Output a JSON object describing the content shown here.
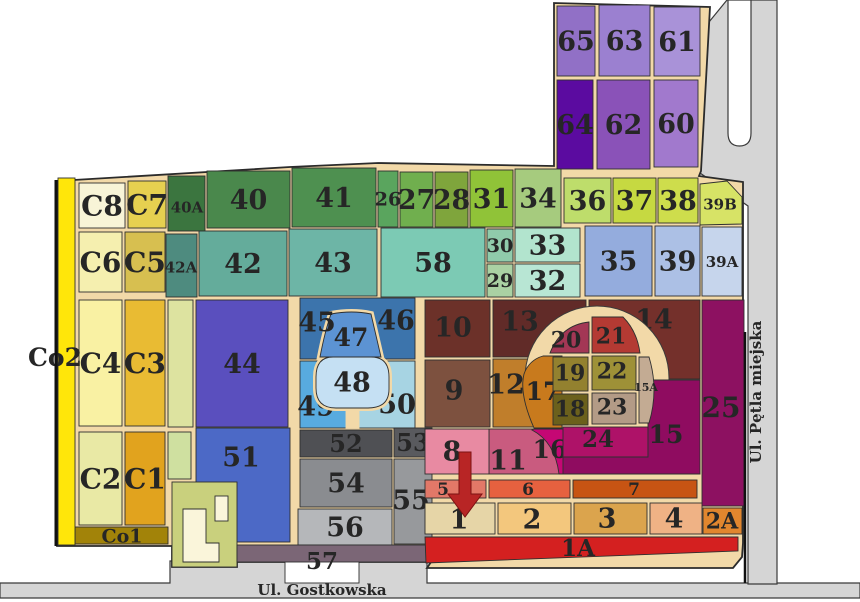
{
  "map": {
    "colors": {
      "road_fill": "#d5d5d5",
      "road_stroke": "#3a3a3a",
      "path_fill": "#f2d9a8",
      "outline": "#2b2b2b",
      "plot_stroke": "#2f2f2f",
      "label_color": "#262626",
      "arrow_color": "#b82525"
    },
    "base": "57,181 290,167 378,163 554,166 554,3 710,7 701,171 699,176 743,182 743,543 742,557 733,568 427,568 431,562 237,562 237,567 172,567 172,546 57,546",
    "roads": [
      {
        "name": "road-gostkowska-surface",
        "pg": "0,583 170,583 170,561 427,561 427,583 860,583 860,598 0,598"
      },
      {
        "name": "road-petla-miejska-surface",
        "pg": "700,33 727,0 777,0 777,584 748,584 748,206 700,173"
      },
      {
        "name": "turning-loop-island",
        "p": "M 728,0 L 728,133 Q 728,146 739.5,146 Q 751,146 751,133 L 751,0 Z",
        "c": "#ffffff"
      }
    ],
    "plots": [
      {
        "n": "65",
        "c": "#9170c6",
        "r": [
          557,
          6,
          38,
          70
        ]
      },
      {
        "n": "63",
        "c": "#9b80d0",
        "r": [
          599,
          5,
          51,
          71
        ]
      },
      {
        "n": "61",
        "c": "#a992d8",
        "r": [
          654,
          7,
          46,
          69
        ]
      },
      {
        "n": "64",
        "c": "#5b0ba0",
        "r": [
          557,
          80,
          36,
          89
        ]
      },
      {
        "n": "62",
        "c": "#8a52b8",
        "r": [
          597,
          80,
          53,
          89
        ]
      },
      {
        "n": "60",
        "c": "#a179cd",
        "r": [
          654,
          80,
          44,
          87
        ]
      },
      {
        "n": "C8",
        "c": "#f8f4d7",
        "r": [
          79,
          183,
          46,
          45
        ],
        "fs": 28
      },
      {
        "n": "C7",
        "c": "#e6d050",
        "r": [
          128,
          181,
          38,
          47
        ],
        "fs": 28
      },
      {
        "n": "40A",
        "c": "#3b753f",
        "r": [
          168,
          176,
          37,
          55
        ],
        "fs": 15,
        "lx": 187,
        "ly": 207
      },
      {
        "n": "40",
        "c": "#4a884c",
        "r": [
          207,
          171,
          83,
          57
        ]
      },
      {
        "n": "41",
        "c": "#4e9050",
        "r": [
          292,
          168,
          84,
          59
        ]
      },
      {
        "n": "26",
        "c": "#5aa55e",
        "r": [
          378,
          171,
          20,
          56
        ],
        "fs": 19
      },
      {
        "n": "27",
        "c": "#70af4e",
        "r": [
          400,
          172,
          33,
          55
        ]
      },
      {
        "n": "28",
        "c": "#7fa53c",
        "r": [
          435,
          172,
          33,
          55
        ]
      },
      {
        "n": "31",
        "c": "#90c338",
        "r": [
          470,
          170,
          43,
          57
        ]
      },
      {
        "n": "34",
        "c": "#a6cb7e",
        "r": [
          515,
          169,
          46,
          58
        ]
      },
      {
        "n": "36",
        "c": "#bedd6b",
        "r": [
          564,
          178,
          47,
          45
        ]
      },
      {
        "n": "37",
        "c": "#c6d941",
        "r": [
          613,
          178,
          43,
          45
        ]
      },
      {
        "n": "38",
        "c": "#cedd4c",
        "r": [
          658,
          178,
          40,
          45
        ]
      },
      {
        "n": "39B",
        "c": "#d7e366",
        "pg": "700,184 727,181 742,197 742,224 700,225",
        "fs": 15,
        "lx": 720,
        "ly": 204
      },
      {
        "n": "C6",
        "c": "#f5efaf",
        "r": [
          79,
          232,
          43,
          60
        ],
        "fs": 28
      },
      {
        "n": "C5",
        "c": "#d7bf50",
        "r": [
          125,
          232,
          40,
          60
        ],
        "fs": 28
      },
      {
        "n": "42A",
        "c": "#4e8b7f",
        "r": [
          166,
          234,
          31,
          63
        ],
        "fs": 15,
        "lx": 181,
        "ly": 267
      },
      {
        "n": "42",
        "c": "#64ac9b",
        "r": [
          199,
          231,
          88,
          65
        ]
      },
      {
        "n": "43",
        "c": "#6db5a6",
        "r": [
          289,
          229,
          88,
          67
        ]
      },
      {
        "n": "58",
        "c": "#7ccab4",
        "r": [
          381,
          228,
          104,
          69
        ]
      },
      {
        "n": "30",
        "c": "#90cbab",
        "r": [
          487,
          229,
          26,
          33
        ],
        "fs": 19
      },
      {
        "n": "33",
        "c": "#b2e4ce",
        "r": [
          515,
          228,
          65,
          34
        ]
      },
      {
        "n": "29",
        "c": "#aad1a3",
        "r": [
          487,
          264,
          26,
          33
        ],
        "fs": 19
      },
      {
        "n": "32",
        "c": "#b8e6d4",
        "r": [
          515,
          264,
          65,
          33
        ]
      },
      {
        "n": "35",
        "c": "#94acdd",
        "r": [
          585,
          226,
          67,
          70
        ]
      },
      {
        "n": "39",
        "c": "#acc0e5",
        "r": [
          655,
          226,
          45,
          70
        ]
      },
      {
        "n": "39A",
        "c": "#c6d5ec",
        "r": [
          702,
          227,
          40,
          69
        ],
        "fs": 15
      },
      {
        "name": "green-strip-upper",
        "c": "#dde3a0",
        "r": [
          168,
          300,
          25,
          127
        ]
      },
      {
        "n": "C4",
        "c": "#f9f1a3",
        "r": [
          79,
          300,
          43,
          126
        ],
        "fs": 28
      },
      {
        "n": "C3",
        "c": "#e9bb33",
        "r": [
          125,
          300,
          40,
          126
        ],
        "fs": 28
      },
      {
        "n": "44",
        "c": "#5a4fbe",
        "r": [
          196,
          300,
          92,
          127
        ]
      },
      {
        "name": "block-45-46",
        "c": "#3c74ac",
        "r": [
          300,
          298,
          115,
          61
        ]
      },
      {
        "n": "49",
        "c": "#58abdf",
        "r": [
          300,
          361,
          57,
          67
        ],
        "lx": 316,
        "ly": 406
      },
      {
        "n": "50",
        "c": "#a7d4e3",
        "r": [
          357,
          361,
          58,
          67
        ],
        "lx": 397,
        "ly": 404
      },
      {
        "name": "goblet-stem",
        "c": "#f2d9a8",
        "sc": "#f2d9a8",
        "r": [
          346,
          406,
          13,
          22
        ]
      },
      {
        "name": "goblet-outline-upper",
        "halo": "M 331,314 Q 352,310 371,314 L 381,357 L 320,357 Q 325,331 331,314 Z"
      },
      {
        "name": "goblet-outline-lower",
        "halo": "M 333,357 L 371,357 Q 389,357 389,377 L 389,389 Q 389,408 368,408 L 336,408 Q 316,408 316,388 L 316,377 Q 316,357 333,357 Z"
      },
      {
        "n": "47",
        "c": "#5c93d3",
        "p": "M 331,314 Q 352,310 371,314 L 381,357 L 320,357 Q 325,331 331,314 Z",
        "lx": 351,
        "ly": 337,
        "fs": 25
      },
      {
        "n": "48",
        "c": "#c5e0f3",
        "p": "M 333,357 L 371,357 Q 389,357 389,377 L 389,389 Q 389,408 368,408 L 336,408 Q 316,408 316,388 L 316,377 Q 316,357 333,357 Z",
        "lx": 352,
        "ly": 382
      },
      {
        "n": "45",
        "lx": 317,
        "ly": 322
      },
      {
        "n": "46",
        "lx": 396,
        "ly": 320
      },
      {
        "n": "10",
        "c": "#6c3129",
        "r": [
          425,
          300,
          65,
          57
        ],
        "lx": 453,
        "ly": 327
      },
      {
        "n": "13",
        "c": "#612b28",
        "r": [
          493,
          300,
          93,
          57
        ],
        "lx": 520,
        "ly": 321
      },
      {
        "n": "14",
        "c": "#74302b",
        "r": [
          589,
          300,
          111,
          79
        ],
        "lx": 654,
        "ly": 319
      },
      {
        "n": "9",
        "c": "#7d513f",
        "r": [
          425,
          360,
          65,
          67
        ],
        "lx": 454,
        "ly": 390
      },
      {
        "n": "12",
        "c": "#c07e2b",
        "r": [
          493,
          359,
          50,
          68
        ],
        "lx": 506,
        "ly": 384
      },
      {
        "n": "25",
        "c": "#8d1161",
        "r": [
          702,
          300,
          42,
          206
        ],
        "lx": 721,
        "ly": 407,
        "fs": 28
      },
      {
        "name": "ring-road-circle",
        "circle": [
          597,
          378,
          72
        ]
      },
      {
        "n": "11",
        "c": "#c95b7f",
        "r": [
          489,
          429,
          71,
          45
        ],
        "lx": 508,
        "ly": 460
      },
      {
        "n": "16",
        "c": "#c50774",
        "p": "M 534,429 L 589,429 L 589,474 L 559,474 Q 555,442 532,430 Z",
        "lx": 550,
        "ly": 449,
        "fs": 25
      },
      {
        "n": "24",
        "c": "#ae1268",
        "r": [
          563,
          427,
          85,
          30
        ],
        "lx": 598,
        "ly": 439,
        "fs": 23
      },
      {
        "n": "15",
        "c": "#8f0c60",
        "p": "M 648,380 L 700,380 L 700,474 L 563,474 L 563,457 L 648,457 Z",
        "lx": 666,
        "ly": 434,
        "fs": 25
      },
      {
        "n": "17",
        "c": "#c87a1d",
        "p": "M 543,356 L 562,356 L 562,428 L 534,428 Q 519,394 524,374 Q 529,360 543,356 Z",
        "lx": 543,
        "ly": 391,
        "fs": 25
      },
      {
        "n": "20",
        "c": "#a33755",
        "p": "M 550,353 L 589,353 L 589,322 Q 561,325 550,353 Z",
        "lx": 566,
        "ly": 340,
        "fs": 22
      },
      {
        "n": "21",
        "c": "#b43a33",
        "p": "M 592,353 L 592,317 L 623,317 Q 637,331 640,353 Z",
        "lx": 611,
        "ly": 336,
        "fs": 22
      },
      {
        "n": "19",
        "c": "#93812f",
        "r": [
          553,
          357,
          35,
          34
        ],
        "lx": 570,
        "ly": 373,
        "fs": 22
      },
      {
        "n": "22",
        "c": "#9e9137",
        "r": [
          592,
          356,
          44,
          34
        ],
        "lx": 612,
        "ly": 371,
        "fs": 22
      },
      {
        "n": "18",
        "c": "#6b601c",
        "r": [
          553,
          394,
          35,
          31
        ],
        "lx": 570,
        "ly": 409,
        "fs": 22
      },
      {
        "n": "23",
        "c": "#b39b86",
        "r": [
          592,
          393,
          44,
          31
        ],
        "lx": 612,
        "ly": 407,
        "fs": 22
      },
      {
        "n": "15A",
        "c": "#c3ab93",
        "p": "M 639,357 L 649,357 Q 659,390 649,423 L 639,423 Z",
        "lx": 646,
        "ly": 387,
        "fs": 11
      },
      {
        "n": "C2",
        "c": "#e9e9a5",
        "r": [
          79,
          432,
          43,
          93
        ],
        "fs": 28
      },
      {
        "n": "C1",
        "c": "#e1a31e",
        "r": [
          125,
          432,
          40,
          93
        ],
        "fs": 28
      },
      {
        "name": "green-strip-lower",
        "c": "#cfe0a0",
        "r": [
          168,
          432,
          23,
          47
        ]
      },
      {
        "n": "51",
        "c": "#4c69c6",
        "r": [
          196,
          428,
          94,
          114
        ],
        "lx": 241,
        "ly": 457
      },
      {
        "name": "building-parcel",
        "c": "#c9d07d",
        "r": [
          172,
          482,
          65,
          85
        ]
      },
      {
        "name": "building-main",
        "c": "#faf5da",
        "p": "M 183,509 L 206,509 L 206,543 L 219,543 L 219,562 L 183,562 Z"
      },
      {
        "name": "building-annex",
        "c": "#faf5da",
        "r": [
          215,
          496,
          13,
          25
        ]
      },
      {
        "n": "52",
        "c": "#4f5054",
        "r": [
          300,
          430,
          92,
          27
        ],
        "fs": 24
      },
      {
        "n": "53",
        "c": "#595a5e",
        "r": [
          394,
          428,
          38,
          29
        ],
        "fs": 24
      },
      {
        "n": "54",
        "c": "#8a8c90",
        "r": [
          300,
          459,
          92,
          48
        ]
      },
      {
        "n": "55",
        "c": "#97999c",
        "r": [
          394,
          459,
          38,
          85
        ],
        "lx": 411,
        "ly": 500
      },
      {
        "n": "56",
        "c": "#b5b7ba",
        "r": [
          298,
          509,
          94,
          36
        ]
      },
      {
        "name": "gate-box-57",
        "c": "#ffffff",
        "r": [
          285,
          560,
          74,
          23
        ]
      },
      {
        "n": "57",
        "c": "#7b6676",
        "r": [
          237,
          545,
          195,
          17
        ],
        "lx": 322,
        "ly": 561,
        "fs": 23
      },
      {
        "n": "8",
        "c": "#e88aa2",
        "r": [
          425,
          429,
          64,
          45
        ],
        "lx": 452,
        "ly": 451
      },
      {
        "n": "5",
        "c": "#e27868",
        "r": [
          425,
          480,
          61,
          18
        ],
        "fs": 17,
        "lx": 443,
        "ly": 489
      },
      {
        "n": "6",
        "c": "#e6613f",
        "r": [
          489,
          480,
          81,
          18
        ],
        "fs": 17,
        "lx": 528,
        "ly": 489
      },
      {
        "n": "7",
        "c": "#c75413",
        "r": [
          573,
          480,
          124,
          18
        ],
        "fs": 17,
        "lx": 634,
        "ly": 489
      },
      {
        "n": "1",
        "c": "#e6d5a7",
        "r": [
          425,
          503,
          70,
          31
        ],
        "lx": 459,
        "ly": 519
      },
      {
        "n": "2",
        "c": "#f3c77d",
        "r": [
          498,
          503,
          73,
          31
        ],
        "lx": 532,
        "ly": 519
      },
      {
        "n": "3",
        "c": "#dba44d",
        "r": [
          574,
          503,
          73,
          31
        ],
        "lx": 607,
        "ly": 518
      },
      {
        "n": "4",
        "c": "#efb285",
        "r": [
          650,
          503,
          52,
          31
        ],
        "lx": 674,
        "ly": 518
      },
      {
        "n": "2A",
        "c": "#e1862e",
        "r": [
          703,
          508,
          39,
          26
        ],
        "fs": 22,
        "lx": 722,
        "ly": 521
      },
      {
        "n": "1A",
        "c": "#d42020",
        "pg": "425,537 738,537 738,551 426,563",
        "lx": 578,
        "ly": 548,
        "fs": 23
      },
      {
        "n": "Co1",
        "c": "#a28309",
        "r": [
          75,
          527,
          93,
          17
        ],
        "fs": 19,
        "lx": 122,
        "ly": 536
      },
      {
        "n": "Co2",
        "c": "#ffe60a",
        "r": [
          58,
          178,
          17,
          367
        ],
        "fs": 25,
        "lx": 55,
        "ly": 357
      }
    ],
    "lines": [
      {
        "x1": 56,
        "y1": 180,
        "x2": 56,
        "y2": 546,
        "w": 3
      },
      {
        "x1": 745,
        "y1": 332,
        "x2": 745,
        "y2": 583,
        "w": 2.5
      }
    ],
    "arrow": {
      "d": "M 459,452 L 471,452 L 471,494 L 482,494 L 465,517 L 448,494 L 459,494 Z",
      "fill": "#b82525",
      "stroke": "#7c1212"
    },
    "streets": [
      {
        "name": "street-label-gostkowska",
        "label": "Ul. Gostkowska",
        "x": 322,
        "y": 595,
        "rotate": 0
      },
      {
        "name": "street-label-petla-miejska",
        "label": "Ul. Pętla miejska",
        "x": 761,
        "y": 392,
        "rotate": -90
      }
    ]
  }
}
